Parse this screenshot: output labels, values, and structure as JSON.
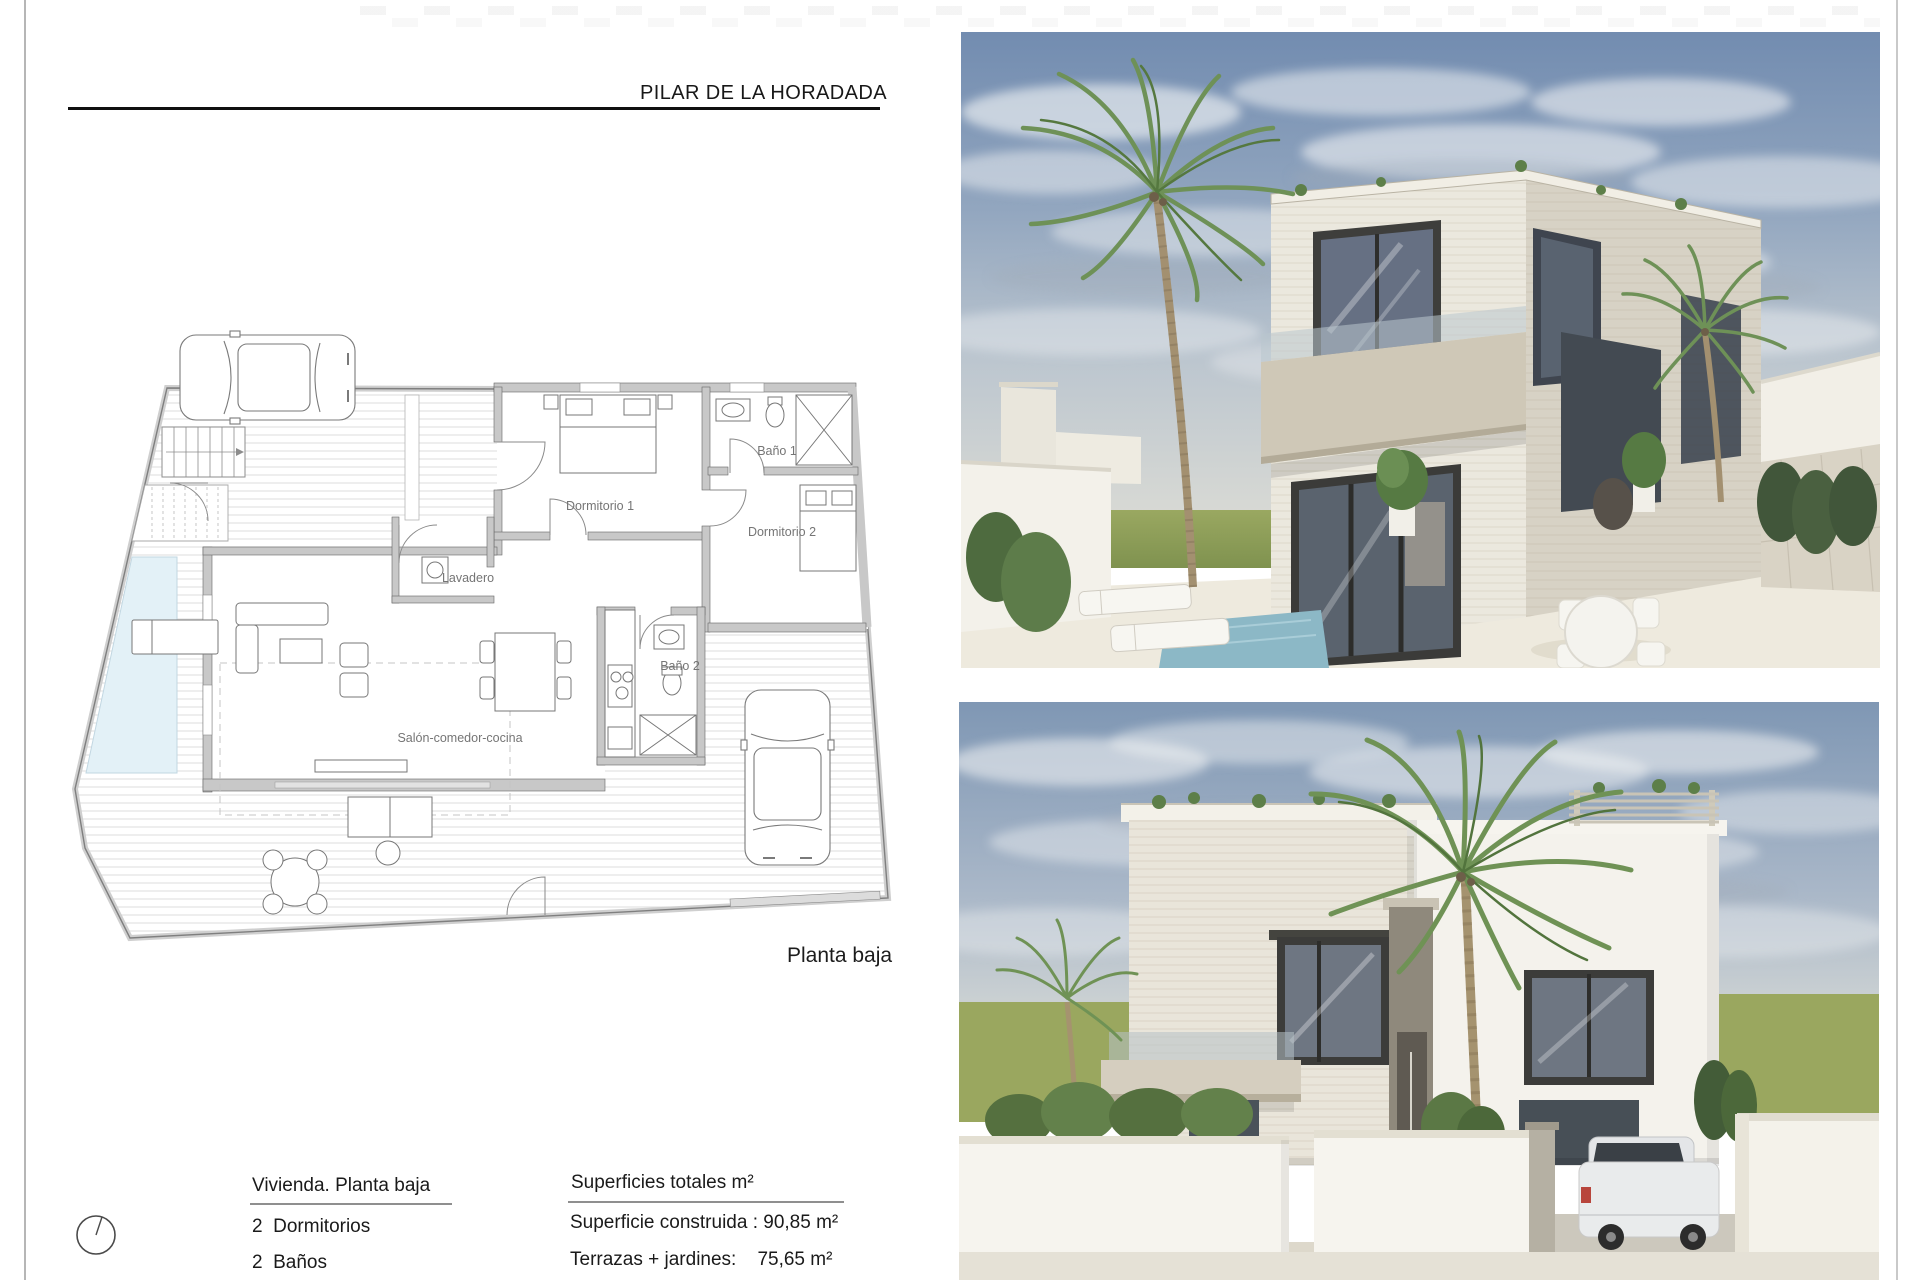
{
  "page": {
    "title": "PILAR DE LA HORADADA",
    "plan_caption": "Planta baja"
  },
  "floor_plan": {
    "labels": {
      "dormitorio1": "Dormitorio 1",
      "bano1": "Baño 1",
      "dormitorio2": "Dormitorio 2",
      "lavadero": "Lavadero",
      "bano2": "Baño 2",
      "salon": "Salón-comedor-cocina"
    },
    "pool_color": "#e3f1f7"
  },
  "details": {
    "heading": "Vivienda. Planta baja",
    "bedrooms": "2  Dormitorios",
    "bathrooms": "2  Baños"
  },
  "areas": {
    "heading": "Superficies totales m²",
    "built": "Superficie construida : 90,85 m²",
    "terraces": "Terrazas + jardines:    75,65 m²"
  },
  "icons": {
    "north_indicator": "north-circle"
  },
  "renders": {
    "top": "exterior-render-perspective",
    "bottom": "exterior-render-front-elevation"
  }
}
